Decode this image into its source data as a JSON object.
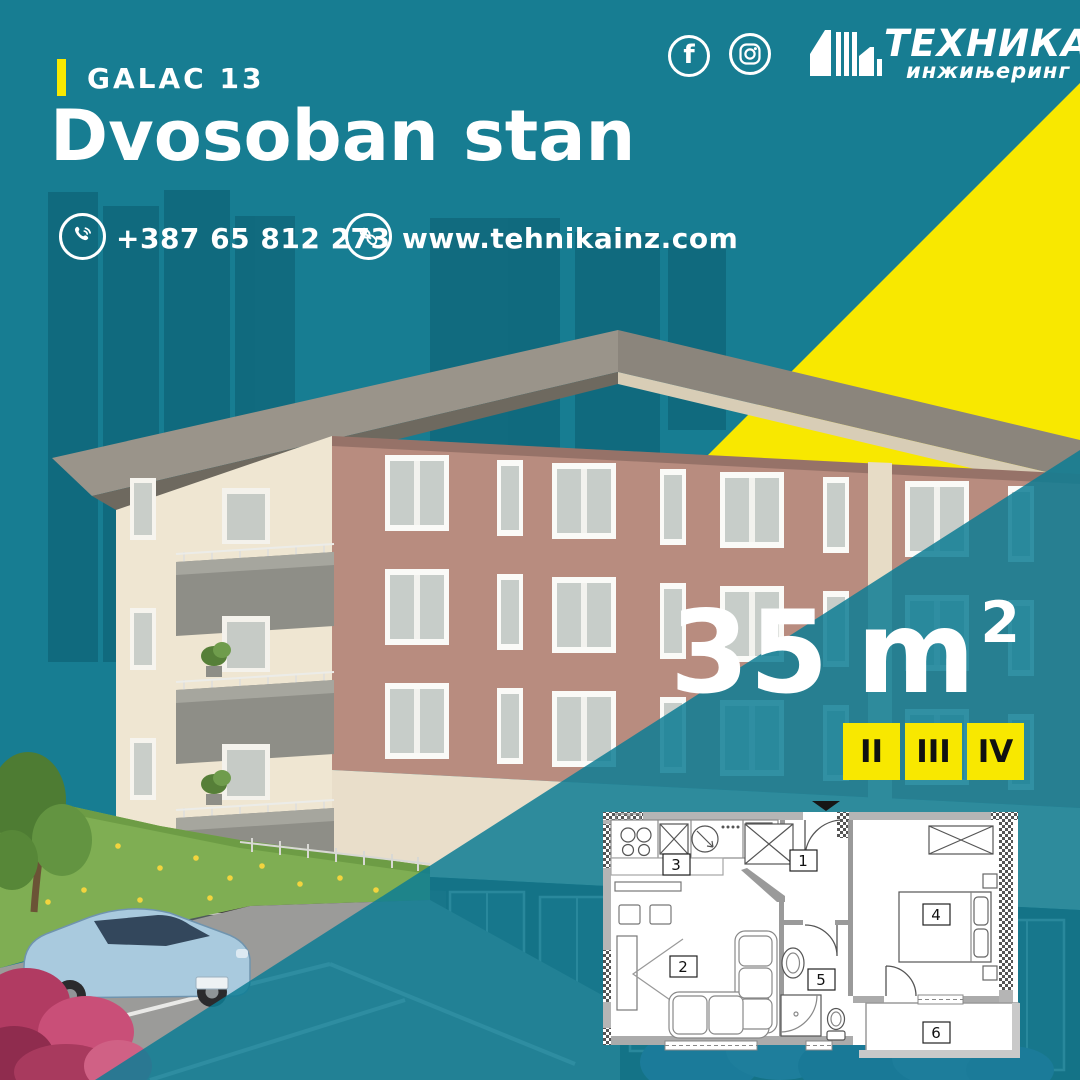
{
  "colors": {
    "teal": "#177d92",
    "yellow": "#f8e800",
    "overlay_teal": "#0d7c94",
    "badge_text": "#111111"
  },
  "header": {
    "project_label": "GALAC 13",
    "title": "Dvosoban stan"
  },
  "contact": {
    "phone": "+387 65 812 273",
    "website": "www.tehnikainz.com"
  },
  "brand": {
    "name": "ТЕХНИКА",
    "subtitle": "инжињеринг",
    "facebook_glyph": "f"
  },
  "listing": {
    "area_value": "35",
    "area_unit": "m",
    "area_superscript": "2",
    "floors": [
      {
        "label": "II"
      },
      {
        "label": "III"
      },
      {
        "label": "IV"
      }
    ]
  },
  "floorplan": {
    "rooms": [
      {
        "number": "1"
      },
      {
        "number": "2"
      },
      {
        "number": "3"
      },
      {
        "number": "4"
      },
      {
        "number": "5"
      },
      {
        "number": "6"
      }
    ]
  }
}
